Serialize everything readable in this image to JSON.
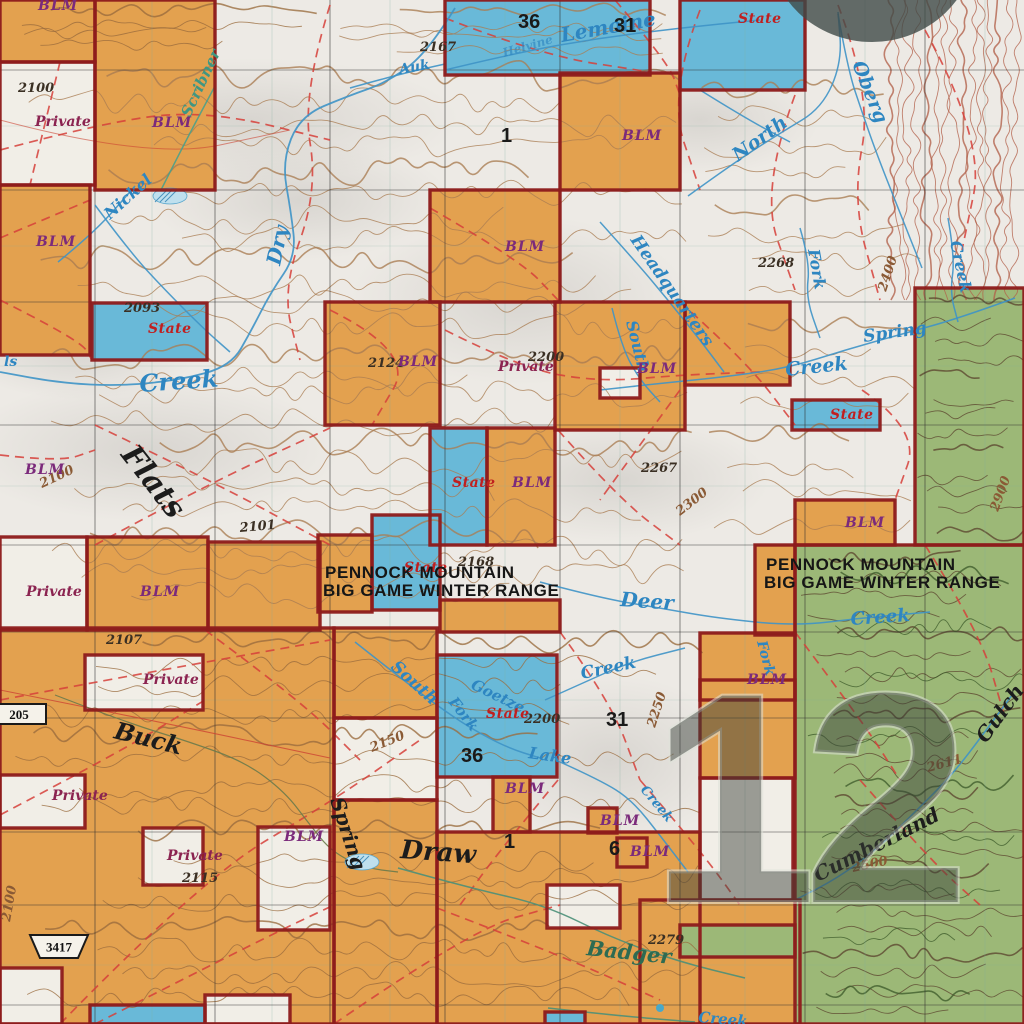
{
  "map": {
    "colors": {
      "blm": "#e3a14f",
      "state": "#69b9d8",
      "private": "#f1eee7",
      "forest": "#9cb877",
      "boundary": "#8e1c1c",
      "grid": "#2f2f2f",
      "trail": "#d6403a",
      "creek": "#3e93c6",
      "contour": "#a97c52"
    },
    "parcels": [
      {
        "o": "blm",
        "r": [
          0,
          0,
          95,
          62
        ]
      },
      {
        "o": "blm",
        "r": [
          95,
          0,
          120,
          190
        ]
      },
      {
        "o": "blm",
        "r": [
          560,
          73,
          120,
          117
        ]
      },
      {
        "o": "blm",
        "r": [
          0,
          185,
          90,
          170
        ]
      },
      {
        "o": "blm",
        "r": [
          430,
          190,
          130,
          112
        ]
      },
      {
        "o": "blm",
        "r": [
          325,
          302,
          115,
          123
        ]
      },
      {
        "o": "blm",
        "r": [
          555,
          302,
          130,
          128
        ]
      },
      {
        "o": "blm",
        "r": [
          685,
          302,
          105,
          83
        ]
      },
      {
        "o": "blm",
        "r": [
          487,
          428,
          68,
          117
        ]
      },
      {
        "o": "blm",
        "r": [
          795,
          500,
          100,
          45
        ]
      },
      {
        "o": "blm",
        "r": [
          755,
          545,
          40,
          90
        ]
      },
      {
        "o": "blm",
        "r": [
          700,
          633,
          95,
          67
        ]
      },
      {
        "o": "blm",
        "r": [
          87,
          537,
          121,
          93
        ]
      },
      {
        "o": "blm",
        "r": [
          208,
          542,
          112,
          88
        ]
      },
      {
        "o": "blm",
        "r": [
          318,
          535,
          54,
          77
        ]
      },
      {
        "o": "blm",
        "r": [
          440,
          600,
          120,
          32
        ]
      },
      {
        "o": "blm",
        "r": [
          0,
          628,
          334,
          396
        ]
      },
      {
        "o": "blm",
        "r": [
          334,
          628,
          103,
          90
        ]
      },
      {
        "o": "blm",
        "r": [
          334,
          800,
          103,
          224
        ]
      },
      {
        "o": "blm",
        "r": [
          437,
          832,
          263,
          192
        ]
      },
      {
        "o": "blm",
        "r": [
          640,
          900,
          160,
          124
        ]
      },
      {
        "o": "blm",
        "r": [
          700,
          680,
          95,
          98
        ]
      },
      {
        "o": "blm",
        "r": [
          493,
          777,
          37,
          55
        ]
      },
      {
        "o": "blm",
        "r": [
          588,
          808,
          29,
          25
        ]
      },
      {
        "o": "blm",
        "r": [
          617,
          838,
          30,
          29
        ]
      },
      {
        "o": "state",
        "r": [
          445,
          0,
          205,
          75
        ]
      },
      {
        "o": "state",
        "r": [
          680,
          0,
          125,
          90
        ]
      },
      {
        "o": "state",
        "r": [
          92,
          303,
          115,
          57
        ]
      },
      {
        "o": "state",
        "r": [
          792,
          400,
          88,
          30
        ]
      },
      {
        "o": "state",
        "r": [
          430,
          428,
          57,
          117
        ]
      },
      {
        "o": "state",
        "r": [
          372,
          515,
          68,
          95
        ]
      },
      {
        "o": "state",
        "r": [
          437,
          655,
          120,
          122
        ]
      },
      {
        "o": "state",
        "r": [
          90,
          1005,
          115,
          19
        ]
      },
      {
        "o": "state",
        "r": [
          545,
          1012,
          40,
          12
        ]
      },
      {
        "o": "private",
        "r": [
          0,
          62,
          95,
          123
        ]
      },
      {
        "o": "private",
        "r": [
          600,
          368,
          40,
          30
        ]
      },
      {
        "o": "private",
        "r": [
          0,
          537,
          87,
          93
        ]
      },
      {
        "o": "private",
        "r": [
          85,
          655,
          118,
          55
        ]
      },
      {
        "o": "private",
        "r": [
          0,
          775,
          85,
          53
        ]
      },
      {
        "o": "private",
        "r": [
          143,
          828,
          60,
          57
        ]
      },
      {
        "o": "private",
        "r": [
          258,
          827,
          72,
          103
        ]
      },
      {
        "o": "private",
        "r": [
          547,
          885,
          73,
          43
        ]
      },
      {
        "o": "private",
        "r": [
          700,
          778,
          93,
          122
        ]
      },
      {
        "o": "private",
        "r": [
          0,
          968,
          62,
          56
        ]
      },
      {
        "o": "private",
        "r": [
          205,
          995,
          85,
          29
        ]
      },
      {
        "o": "private",
        "r": [
          334,
          718,
          103,
          82
        ]
      },
      {
        "o": "forest",
        "r": [
          915,
          288,
          109,
          257
        ]
      },
      {
        "o": "forest",
        "r": [
          680,
          925,
          115,
          32
        ]
      },
      {
        "o": "forest",
        "r": [
          795,
          545,
          229,
          479
        ]
      }
    ],
    "ownership_labels": [
      {
        "t": "BLM",
        "x": 38,
        "y": 10
      },
      {
        "t": "BLM",
        "x": 152,
        "y": 127
      },
      {
        "t": "BLM",
        "x": 622,
        "y": 140
      },
      {
        "t": "BLM",
        "x": 36,
        "y": 246
      },
      {
        "t": "BLM",
        "x": 505,
        "y": 251
      },
      {
        "t": "BLM",
        "x": 398,
        "y": 366
      },
      {
        "t": "BLM",
        "x": 637,
        "y": 373
      },
      {
        "t": "BLM",
        "x": 25,
        "y": 474
      },
      {
        "t": "BLM",
        "x": 512,
        "y": 487
      },
      {
        "t": "BLM",
        "x": 140,
        "y": 596
      },
      {
        "t": "BLM",
        "x": 845,
        "y": 527
      },
      {
        "t": "BLM",
        "x": 747,
        "y": 684
      },
      {
        "t": "BLM",
        "x": 505,
        "y": 793
      },
      {
        "t": "BLM",
        "x": 600,
        "y": 825
      },
      {
        "t": "BLM",
        "x": 630,
        "y": 856
      },
      {
        "t": "BLM",
        "x": 284,
        "y": 841
      }
    ],
    "state_labels": [
      {
        "t": "State",
        "x": 738,
        "y": 23
      },
      {
        "t": "State",
        "x": 148,
        "y": 333
      },
      {
        "t": "State",
        "x": 452,
        "y": 487
      },
      {
        "t": "State",
        "x": 830,
        "y": 419
      },
      {
        "t": "State",
        "x": 404,
        "y": 572
      },
      {
        "t": "State",
        "x": 486,
        "y": 718
      }
    ],
    "private_labels": [
      {
        "t": "Private",
        "x": 35,
        "y": 126
      },
      {
        "t": "Private",
        "x": 26,
        "y": 596
      },
      {
        "t": "Private",
        "x": 143,
        "y": 684
      },
      {
        "t": "Private",
        "x": 498,
        "y": 371
      },
      {
        "t": "Private",
        "x": 52,
        "y": 800
      },
      {
        "t": "Private",
        "x": 167,
        "y": 860
      }
    ],
    "section_numbers": [
      {
        "n": "36",
        "x": 518,
        "y": 28
      },
      {
        "n": "31",
        "x": 614,
        "y": 32
      },
      {
        "n": "1",
        "x": 501,
        "y": 142
      },
      {
        "n": "31",
        "x": 606,
        "y": 726
      },
      {
        "n": "36",
        "x": 461,
        "y": 762
      },
      {
        "n": "1",
        "x": 504,
        "y": 848
      },
      {
        "n": "6",
        "x": 609,
        "y": 855
      }
    ],
    "elevations": [
      {
        "v": "2100",
        "x": 18,
        "y": 92
      },
      {
        "v": "2167",
        "x": 420,
        "y": 51
      },
      {
        "v": "2093",
        "x": 124,
        "y": 312
      },
      {
        "v": "2101",
        "x": 240,
        "y": 532,
        "r": -5
      },
      {
        "v": "2107",
        "x": 106,
        "y": 644
      },
      {
        "v": "2115",
        "x": 182,
        "y": 882
      },
      {
        "v": "2124",
        "x": 368,
        "y": 367
      },
      {
        "v": "2168",
        "x": 458,
        "y": 566
      },
      {
        "v": "2200",
        "x": 528,
        "y": 361
      },
      {
        "v": "2200",
        "x": 524,
        "y": 723
      },
      {
        "v": "2250",
        "x": 655,
        "y": 728,
        "r": -72,
        "tone": "brown"
      },
      {
        "v": "2267",
        "x": 641,
        "y": 472
      },
      {
        "v": "2279",
        "x": 648,
        "y": 944
      },
      {
        "v": "2300",
        "x": 680,
        "y": 516,
        "r": -38,
        "tone": "brown"
      },
      {
        "v": "2400",
        "x": 886,
        "y": 292,
        "r": -72,
        "tone": "brown"
      },
      {
        "v": "2500",
        "x": 853,
        "y": 872,
        "r": -12,
        "tone": "brown"
      },
      {
        "v": "2611",
        "x": 928,
        "y": 772,
        "r": -15,
        "tone": "brown"
      },
      {
        "v": "2268",
        "x": 758,
        "y": 267
      },
      {
        "v": "2150",
        "x": 372,
        "y": 752,
        "r": -22,
        "tone": "brown"
      },
      {
        "v": "2100",
        "x": 42,
        "y": 488,
        "r": -25,
        "tone": "brown"
      },
      {
        "v": "2100",
        "x": 10,
        "y": 922,
        "r": -80,
        "tone": "brown"
      },
      {
        "v": "2900",
        "x": 998,
        "y": 512,
        "r": -70,
        "tone": "brown"
      }
    ],
    "water_labels": [
      {
        "t": "Lemoine",
        "x": 562,
        "y": 42,
        "r": -10,
        "s": 20
      },
      {
        "t": "Helvine",
        "x": 504,
        "y": 57,
        "r": -16,
        "s": 12,
        "o": 0.65
      },
      {
        "t": "Auk",
        "x": 400,
        "y": 74,
        "r": -10,
        "s": 14
      },
      {
        "t": "Scribner",
        "x": 190,
        "y": 118,
        "r": -65,
        "s": 15,
        "tone": "teal"
      },
      {
        "t": "Nickel",
        "x": 110,
        "y": 220,
        "r": -42,
        "s": 16
      },
      {
        "t": "Dry",
        "x": 280,
        "y": 266,
        "r": -78,
        "s": 20
      },
      {
        "t": "Creek",
        "x": 140,
        "y": 392,
        "r": -4,
        "s": 24
      },
      {
        "t": "ls",
        "x": 4,
        "y": 366,
        "r": 0,
        "s": 14
      },
      {
        "t": "North",
        "x": 738,
        "y": 162,
        "r": -36,
        "s": 19
      },
      {
        "t": "Fork",
        "x": 808,
        "y": 250,
        "r": 80,
        "s": 16
      },
      {
        "t": "Oberg",
        "x": 852,
        "y": 64,
        "r": 68,
        "s": 19
      },
      {
        "t": "Creek",
        "x": 950,
        "y": 242,
        "r": 78,
        "s": 16
      },
      {
        "t": "Headquarters",
        "x": 630,
        "y": 240,
        "r": 55,
        "s": 17
      },
      {
        "t": "South",
        "x": 626,
        "y": 322,
        "r": 76,
        "s": 16
      },
      {
        "t": "Spring",
        "x": 864,
        "y": 342,
        "r": -8,
        "s": 17
      },
      {
        "t": "Creek",
        "x": 786,
        "y": 376,
        "r": -6,
        "s": 19
      },
      {
        "t": "Deer",
        "x": 620,
        "y": 606,
        "r": 4,
        "s": 20
      },
      {
        "t": "Creek",
        "x": 851,
        "y": 625,
        "r": -4,
        "s": 18
      },
      {
        "t": "Fork",
        "x": 757,
        "y": 642,
        "r": 75,
        "s": 14
      },
      {
        "t": "South",
        "x": 390,
        "y": 668,
        "r": 42,
        "s": 17
      },
      {
        "t": "Fork",
        "x": 448,
        "y": 702,
        "r": 52,
        "s": 15
      },
      {
        "t": "Goetze",
        "x": 470,
        "y": 688,
        "r": 26,
        "s": 15
      },
      {
        "t": "Lake",
        "x": 528,
        "y": 758,
        "r": 8,
        "s": 16
      },
      {
        "t": "Creek",
        "x": 582,
        "y": 679,
        "r": -12,
        "s": 17
      },
      {
        "t": "Creek",
        "x": 640,
        "y": 790,
        "r": 50,
        "s": 13
      },
      {
        "t": "Creek",
        "x": 698,
        "y": 1022,
        "r": 5,
        "s": 15
      },
      {
        "t": "Badger",
        "x": 586,
        "y": 955,
        "r": 6,
        "s": 21,
        "tone": "green"
      }
    ],
    "terrain_labels": [
      {
        "t": "Flats",
        "x": 120,
        "y": 455,
        "r": 52,
        "s": 30
      },
      {
        "t": "Draw",
        "x": 400,
        "y": 858,
        "r": 4,
        "s": 26
      },
      {
        "t": "Buck",
        "x": 113,
        "y": 738,
        "r": 14,
        "s": 24
      },
      {
        "t": "Spring",
        "x": 330,
        "y": 800,
        "r": 72,
        "s": 20
      },
      {
        "t": "Cumberland",
        "x": 818,
        "y": 882,
        "r": -27,
        "s": 20
      },
      {
        "t": "Gulch",
        "x": 986,
        "y": 744,
        "r": -54,
        "s": 20
      }
    ],
    "area_labels": [
      {
        "l1": "PENNOCK MOUNTAIN",
        "l2": "BIG GAME WINTER RANGE",
        "x": 325,
        "y": 578
      },
      {
        "l1": "PENNOCK MOUNTAIN",
        "l2": "BIG GAME WINTER RANGE",
        "x": 766,
        "y": 570
      }
    ],
    "road_shields": [
      {
        "n": "205",
        "x": -8,
        "y": 704,
        "w": 54,
        "h": 20,
        "style": "rect"
      },
      {
        "n": "3417",
        "x": 30,
        "y": 935,
        "w": 58,
        "h": 23,
        "style": "trapezoid"
      }
    ],
    "watermark": {
      "n": "12"
    }
  }
}
